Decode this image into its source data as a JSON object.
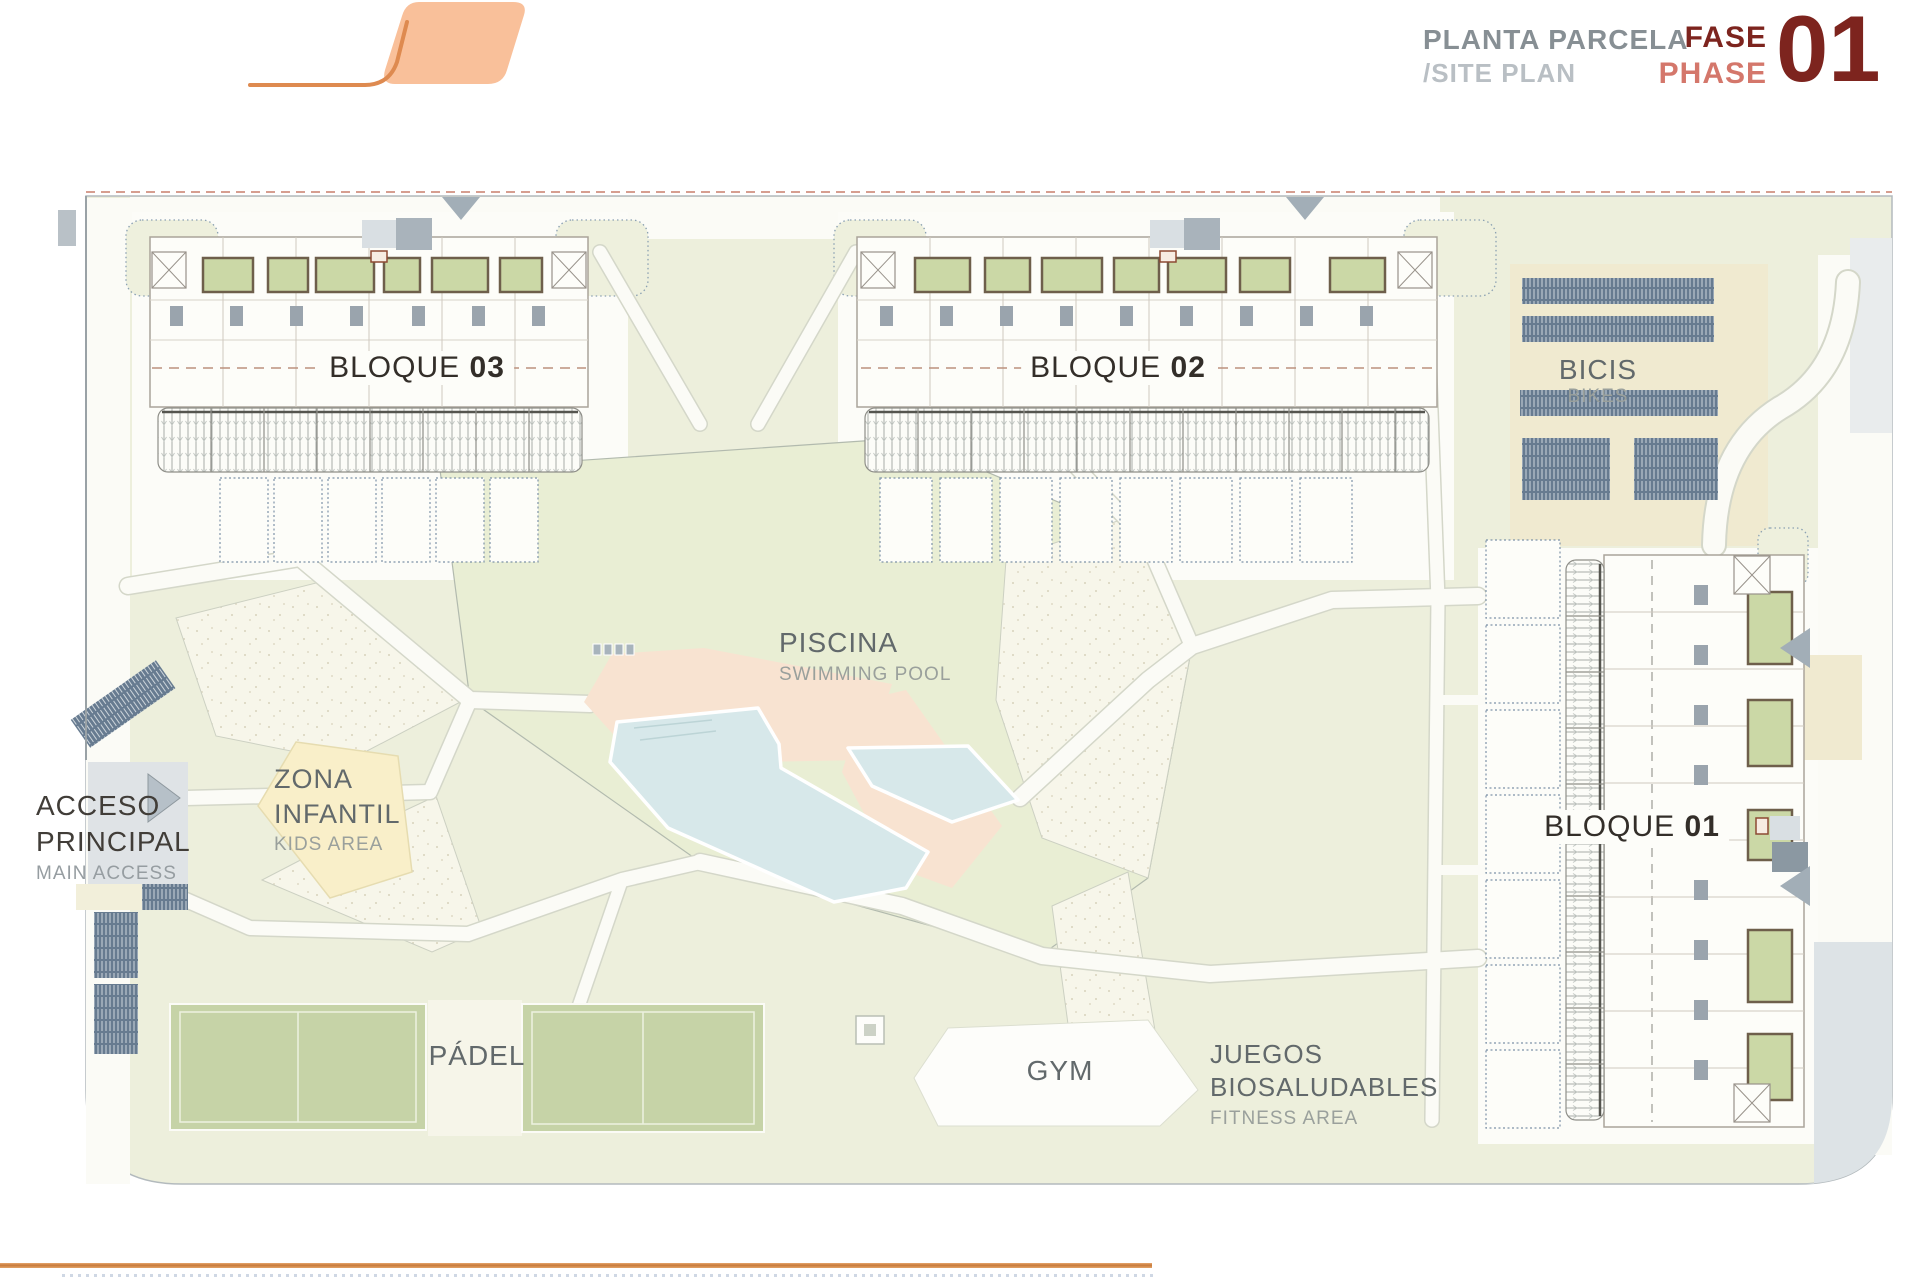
{
  "header": {
    "title": "PLANTA PARCELA",
    "subtitle": "/SITE PLAN",
    "phase": {
      "label_es": "FASE",
      "label_en": "PHASE",
      "number": "01"
    }
  },
  "plan": {
    "blocks": [
      {
        "id": "bloque-03",
        "name": "BLOQUE",
        "number": "03"
      },
      {
        "id": "bloque-02",
        "name": "BLOQUE",
        "number": "02"
      },
      {
        "id": "bloque-01",
        "name": "BLOQUE",
        "number": "01"
      }
    ],
    "areas": {
      "bikes": {
        "label": "BICIS",
        "sublabel": "BIKES"
      },
      "pool": {
        "label": "PISCINA",
        "sublabel": "SWIMMING POOL"
      },
      "kids": {
        "label": "ZONA INFANTIL",
        "sublabel": "KIDS AREA"
      },
      "access": {
        "label": "ACCESO PRINCIPAL",
        "sublabel": "MAIN ACCESS"
      },
      "padel": {
        "label": "PÁDEL"
      },
      "gym": {
        "label": "GYM"
      },
      "fitness": {
        "label": "JUEGOS BIOSALUDABLES",
        "sublabel": "FITNESS AREA"
      }
    }
  },
  "colors": {
    "logo_orange": "#f9c09a",
    "logo_stroke": "#de8a50",
    "phase_dark_red": "#7d241e",
    "phase_light_red": "#d4776b",
    "title_gray": "#878f94",
    "subtitle_gray": "#b9bfc4",
    "grass_green": "#edefdc",
    "patio_green": "#cbd8a6",
    "pool_blue": "#d7e8ea",
    "deck_peach": "#f8e3d1",
    "kids_yellow": "#f9efc9",
    "court_green": "#c6d3a7",
    "bike_slate": "#677b90",
    "boundary_dash_red": "#c97f6b",
    "bottom_rule_orange": "#c87a3a"
  }
}
